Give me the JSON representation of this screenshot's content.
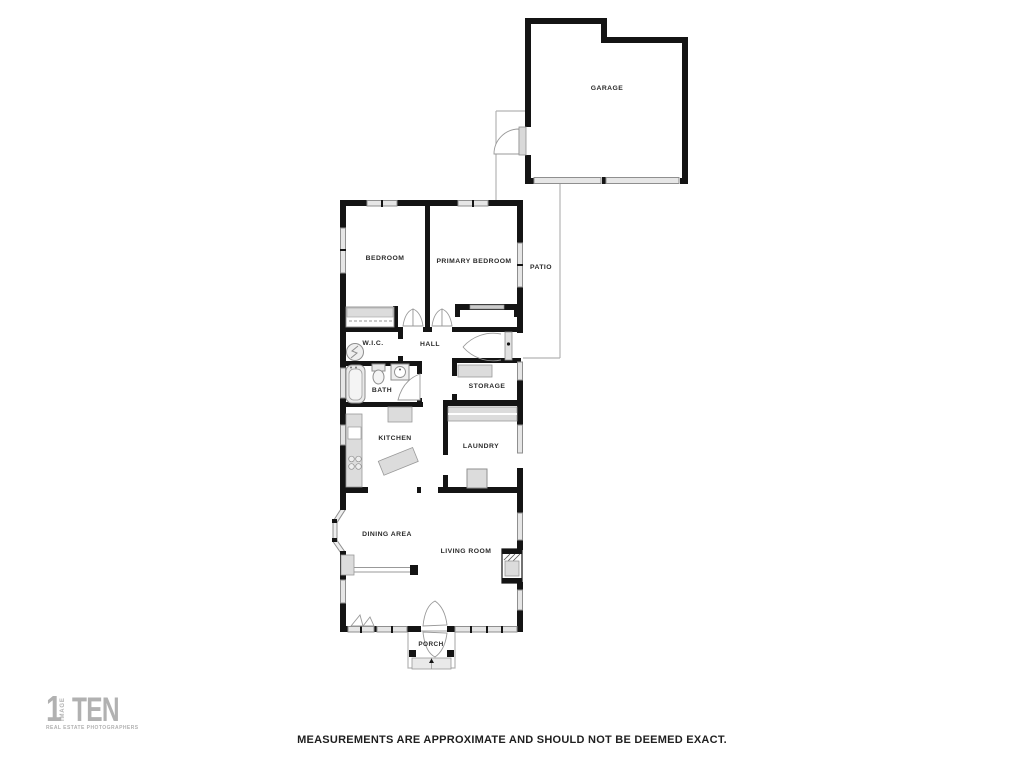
{
  "rooms": {
    "garage": "GARAGE",
    "bedroom": "BEDROOM",
    "primary": "PRIMARY BEDROOM",
    "patio": "PATIO",
    "wic": "W.I.C.",
    "hall": "HALL",
    "bath": "BATH",
    "storage": "STORAGE",
    "kitchen": "KITCHEN",
    "laundry": "LAUNDRY",
    "dining": "DINING AREA",
    "living": "LIVING ROOM",
    "porch": "PORCH"
  },
  "disclaimer": "MEASUREMENTS ARE APPROXIMATE AND SHOULD NOT BE DEEMED EXACT.",
  "logo": {
    "number": "1",
    "vertical_text": "IMAGE",
    "main_text": "TEN",
    "subtitle": "REAL ESTATE PHOTOGRAPHERS"
  },
  "colors": {
    "wall": "#141414",
    "window_fill": "#e6e6e6",
    "window_stroke": "#8f8f8f",
    "fixture_fill": "#e2e2e2",
    "thin_outline": "#b3b3b3",
    "label": "#2a2a2a",
    "logo": "#b1b1b1"
  }
}
